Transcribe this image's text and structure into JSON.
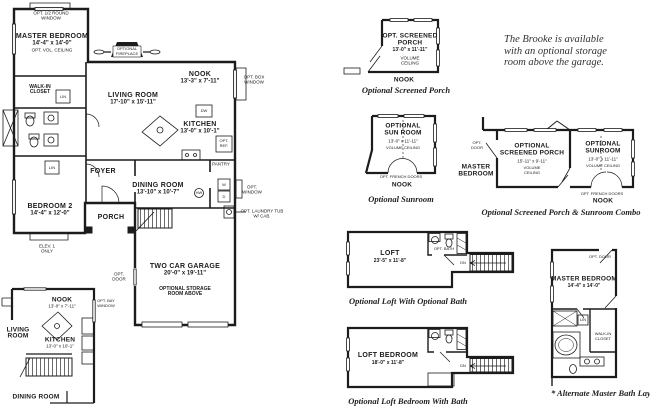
{
  "note": {
    "line1": "The Brooke is available",
    "line2": "with an optional storage",
    "line3": "room above the garage."
  },
  "main_plan": {
    "opt_half_round_window": {
      "l1": "OPT. 1/2 ROUND",
      "l2": "WINDOW"
    },
    "master_bedroom": {
      "name": "MASTER BEDROOM",
      "dims": "14'-4\" x 14'-0\"",
      "note": "OPT. VOL. CEILING"
    },
    "fireplace": {
      "l1": "OPTIONAL",
      "l2": "FIREPLACE"
    },
    "walk_in_closet": {
      "l1": "WALK-IN",
      "l2": "CLOSET"
    },
    "lin_hall": "LIN",
    "lin_foyer": "LIN",
    "nook": {
      "name": "NOOK",
      "dims": "13'-3\" x 7'-11\""
    },
    "opt_box_window": {
      "l1": "OPT. BOX",
      "l2": "WINDOW"
    },
    "living_room": {
      "name": "LIVING ROOM",
      "dims": "17'-10\" x 15'-11\""
    },
    "kitchen": {
      "name": "KITCHEN",
      "dims": "13'-0\" x 10'-1\""
    },
    "dishwasher": "DW",
    "opt_ref": {
      "l1": "OPT.",
      "l2": "REF."
    },
    "pantry": "PANTRY",
    "foyer": "FOYER",
    "dining_room": {
      "name": "DINING ROOM",
      "dims": "13'-10\" x 10'-7\""
    },
    "bedroom_2": {
      "name": "BEDROOM 2",
      "dims": "14'-4\" x 12'-0\""
    },
    "porch": "PORCH",
    "elev": {
      "l1": "ELEV. 1",
      "l2": "ONLY"
    },
    "washer": "W",
    "dryer": "D",
    "hot_water": "HW",
    "opt_window": {
      "l1": "OPT.",
      "l2": "WINDOW"
    },
    "opt_laundry_tub": {
      "l1": "OPT. LAUNDRY TUB",
      "l2": "W/ CAB."
    },
    "opt_door": {
      "l1": "OPT.",
      "l2": "DOOR"
    },
    "garage": {
      "name": "TWO CAR GARAGE",
      "dims": "20'-0\" x 19'-11\"",
      "note1": "OPTIONAL STORAGE",
      "note2": "ROOM ABOVE"
    }
  },
  "inset_plan": {
    "nook": {
      "name": "NOOK",
      "dims": "13'-0\" x 7'-11\""
    },
    "living_room": {
      "l1": "LIVING",
      "l2": "ROOM"
    },
    "kitchen": {
      "name": "KITCHEN",
      "dims": "13'-0\" x 10'-1\""
    },
    "dining_room": "DINING ROOM",
    "opt_bay_window": {
      "l1": "OPT. BAY",
      "l2": "WINDOW"
    }
  },
  "opt_screened_porch": {
    "name1": "OPT. SCREENED",
    "name2": "PORCH",
    "dims": "13'-0\" x 11'-11\"",
    "vol1": "VOLUME",
    "vol2": "CEILING",
    "nook": "NOOK",
    "caption": "Optional Screened Porch"
  },
  "opt_sunroom": {
    "name1": "OPTIONAL",
    "name2": "SUN ROOM",
    "dims": "13'-0\" x 11'-11\"",
    "vol": "VOLUME CEILING",
    "french_doors": "OPT. FRENCH DOORS",
    "nook": "NOOK",
    "caption": "Optional Sunroom"
  },
  "combo": {
    "master1": "MASTER",
    "master2": "BEDROOM",
    "opt_door": {
      "l1": "OPT.",
      "l2": "DOOR"
    },
    "porch1": "OPTIONAL",
    "porch2": "SCREENED PORCH",
    "porch_dims": "15'-11\" x 9'-11\"",
    "porch_vol1": "VOLUME",
    "porch_vol2": "CEILING",
    "sun1": "OPTIONAL",
    "sun2": "SUNROOM",
    "sun_dims": "13'-0\" x 11'-11\"",
    "sun_vol": "VOLUME CEILING",
    "french_doors": "OPT. FRENCH DOORS",
    "nook": "NOOK",
    "caption": "Optional Screened Porch & Sunroom Combo"
  },
  "opt_loft": {
    "name": "LOFT",
    "dims": "23'-5\" x 11'-8\"",
    "opt_bath": "OPT. BATH",
    "dn": "DN",
    "caption": "Optional Loft With Optional Bath"
  },
  "opt_loft_bedroom": {
    "name": "LOFT BEDROOM",
    "dims": "18'-0\" x 11'-8\"",
    "dn": "DN",
    "caption": "Optional Loft Bedroom With Bath"
  },
  "alt_master_bath": {
    "opt_door": "OPT. DOOR",
    "master_bedroom": "MASTER BEDROOM",
    "dims": "14'-4\" x 14'-0\"",
    "walk_in1": "WALK-IN",
    "walk_in2": "CLOSET",
    "lin": "LIN",
    "caption": "* Alternate Master Bath Layout"
  }
}
